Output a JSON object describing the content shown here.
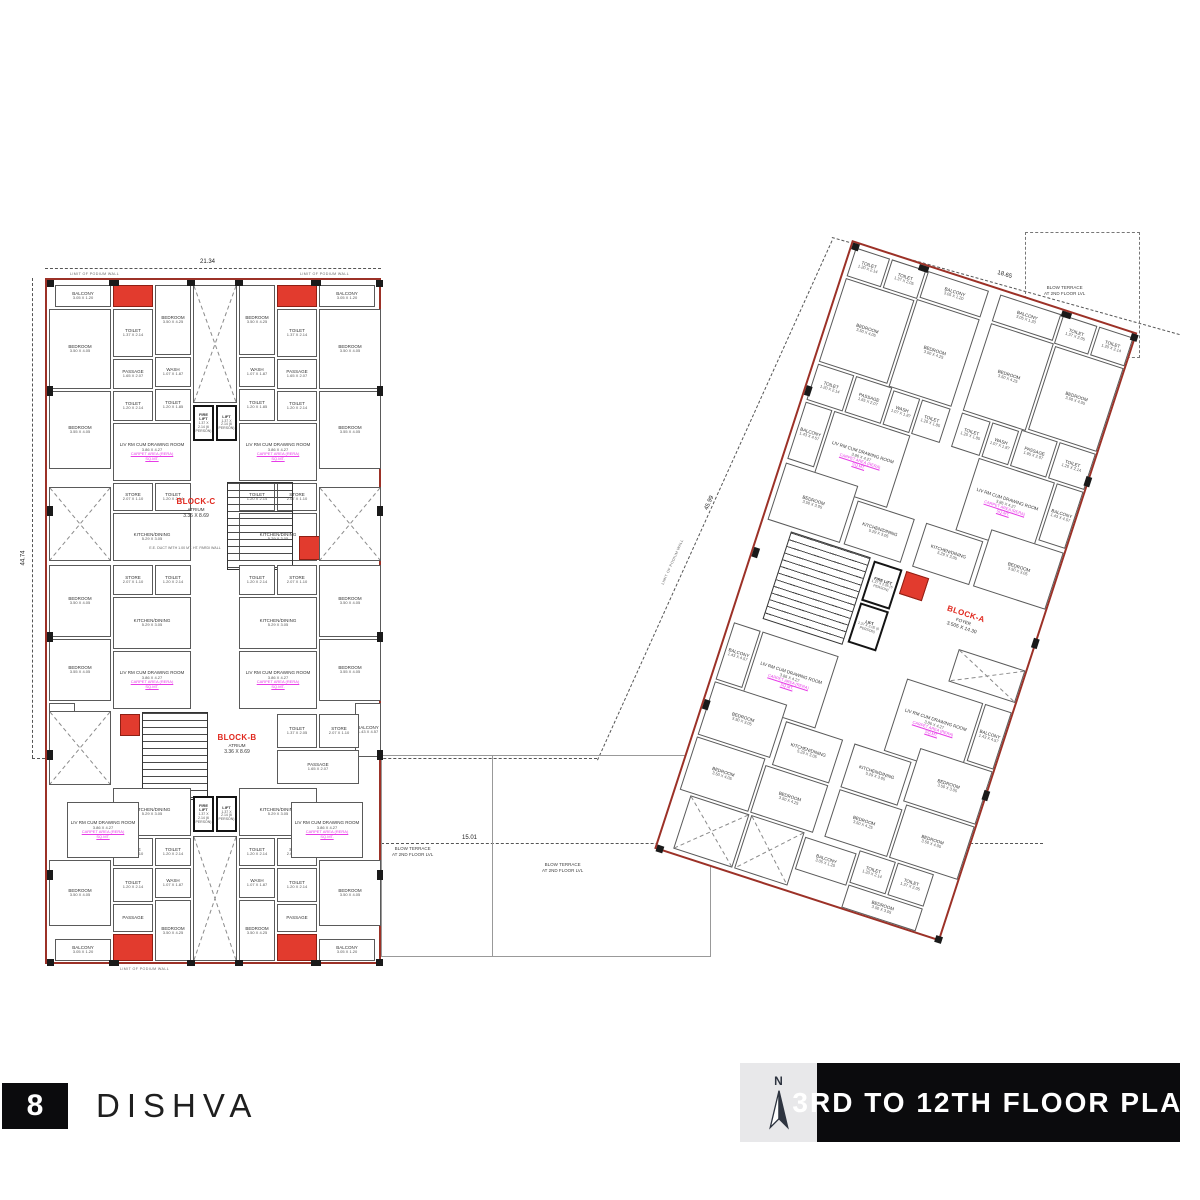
{
  "footer": {
    "page_number": "8",
    "project_name": "DISHVA",
    "plan_title": "3RD TO 12TH FLOOR PLAN",
    "north_label": "N"
  },
  "labels": {
    "carpet_line1": "CARPET AREA (RERA)",
    "carpet_line2": "SQ.MT.",
    "podium": "LIMIT OF PODIUM WALL",
    "terrace": "BLOW TERRACE",
    "terrace_sub": "AT 2ND FLOOR LVL",
    "duct_note": "E.E. DUCT WITH 1.00 MT. HT. PARDI WALL"
  },
  "dimensions": {
    "top": "21.34",
    "left": "44.74",
    "between": "15.01",
    "right_side": "45.99",
    "right_top": "18.65"
  },
  "colors": {
    "perimeter_red": "#9c3127",
    "duct_red": "#e23b2e",
    "block_label_red": "#e0281e",
    "carpet_magenta": "#e73ce7",
    "footer_black": "#0b0b0d",
    "north_box_gray": "#e8e8ea"
  },
  "left_building": {
    "x": 45,
    "y": 278,
    "w": 336,
    "h": 686,
    "rooms": [
      {
        "x": 8,
        "y": 5,
        "w": 56,
        "h": 22,
        "n": "BALCONY",
        "d": "3.05 X 1.20",
        "m": 1
      },
      {
        "x": 66,
        "y": 5,
        "w": 40,
        "h": 22,
        "c": "duct",
        "m": 1
      },
      {
        "x": 2,
        "y": 29,
        "w": 62,
        "h": 80,
        "n": "BEDROOM",
        "d": "3.50 X 4.05",
        "m": 1
      },
      {
        "x": 66,
        "y": 29,
        "w": 40,
        "h": 48,
        "n": "TOILET",
        "d": "1.37 X 2.14",
        "m": 1
      },
      {
        "x": 66,
        "y": 79,
        "w": 40,
        "h": 30,
        "n": "PASSAGE",
        "d": "1.65 X 2.07",
        "m": 1
      },
      {
        "x": 108,
        "y": 5,
        "w": 36,
        "h": 70,
        "n": "BEDROOM",
        "d": "3.50 X 4.25",
        "m": 1
      },
      {
        "x": 108,
        "y": 77,
        "w": 36,
        "h": 30,
        "n": "WASH",
        "d": "1.07 X 1.87",
        "m": 1
      },
      {
        "x": 108,
        "y": 109,
        "w": 36,
        "h": 32,
        "n": "TOILET",
        "d": "1.20 X 1.85",
        "m": 1
      },
      {
        "x": 2,
        "y": 111,
        "w": 62,
        "h": 78,
        "n": "BEDROOM",
        "d": "3.55 X 4.05",
        "m": 1
      },
      {
        "x": 66,
        "y": 111,
        "w": 40,
        "h": 30,
        "n": "TOILET",
        "d": "1.20 X 2.14",
        "m": 1
      },
      {
        "x": 66,
        "y": 143,
        "w": 78,
        "h": 58,
        "n": "LIV RM CUM DRAWING ROOM",
        "d": "3.86 X 4.27",
        "cp": 1,
        "m": 1
      },
      {
        "x": 66,
        "y": 203,
        "w": 40,
        "h": 28,
        "n": "STORE",
        "d": "2.07 X 1.10",
        "m": 1
      },
      {
        "x": 108,
        "y": 203,
        "w": 36,
        "h": 28,
        "n": "TOILET",
        "d": "1.20 X 2.14",
        "m": 1
      },
      {
        "x": 66,
        "y": 233,
        "w": 78,
        "h": 48,
        "n": "KITCHEN/DINING",
        "d": "5.29 X 3.05",
        "m": 1
      },
      {
        "x": 146,
        "y": 5,
        "w": 44,
        "h": 118,
        "c": "terr"
      },
      {
        "x": 146,
        "y": 125,
        "w": 21,
        "h": 36,
        "c": "lift",
        "n": "FIRE LIFT",
        "d": "1.37 X 2.14 (6 PERSON)"
      },
      {
        "x": 169,
        "y": 125,
        "w": 21,
        "h": 36,
        "c": "lift",
        "n": "LIFT",
        "d": "1.37 X 2.14 (6 PERSON)"
      },
      {
        "x": 180,
        "y": 202,
        "w": 66,
        "h": 88,
        "c": "stair"
      },
      {
        "x": 122,
        "y": 206,
        "w": 54,
        "h": 44,
        "c": "blk",
        "n": "BLOCK-C",
        "s": "ATRIUM",
        "d": "3.36 X 8.69"
      },
      {
        "x": 252,
        "y": 256,
        "w": 24,
        "h": 24,
        "c": "duct"
      },
      {
        "x": 100,
        "y": 255,
        "w": 76,
        "h": 26,
        "c": "note",
        "n": "E.E. DUCT WITH 1.00 MT. HT. PARDI WALL"
      },
      {
        "x": 2,
        "y": 207,
        "w": 62,
        "h": 74,
        "c": "terr",
        "m": 1
      },
      {
        "x": 66,
        "y": 285,
        "w": 40,
        "h": 30,
        "n": "STORE",
        "d": "2.07 X 1.10",
        "m": 1
      },
      {
        "x": 108,
        "y": 285,
        "w": 36,
        "h": 30,
        "n": "TOILET",
        "d": "1.20 X 2.14",
        "m": 1
      },
      {
        "x": 2,
        "y": 285,
        "w": 62,
        "h": 72,
        "n": "BEDROOM",
        "d": "3.50 X 4.05",
        "m": 1
      },
      {
        "x": 2,
        "y": 359,
        "w": 62,
        "h": 62,
        "n": "BEDROOM",
        "d": "3.55 X 4.05",
        "m": 1
      },
      {
        "x": 2,
        "y": 423,
        "w": 26,
        "h": 54,
        "n": "BALCONY",
        "d": "1.43 X 4.57",
        "m": 1
      },
      {
        "x": 66,
        "y": 317,
        "w": 78,
        "h": 52,
        "n": "KITCHEN/DINING",
        "d": "5.29 X 3.05",
        "m": 1
      },
      {
        "x": 66,
        "y": 371,
        "w": 78,
        "h": 58,
        "n": "LIV RM CUM DRAWING ROOM",
        "d": "3.86 X 4.27",
        "cp": 1,
        "m": 1
      },
      {
        "x": 95,
        "y": 432,
        "w": 66,
        "h": 88,
        "c": "stair"
      },
      {
        "x": 73,
        "y": 434,
        "w": 20,
        "h": 22,
        "c": "duct"
      },
      {
        "x": 163,
        "y": 442,
        "w": 54,
        "h": 44,
        "c": "blk",
        "n": "BLOCK-B",
        "s": "ATRIUM",
        "d": "3.36 X 8.69"
      },
      {
        "x": 2,
        "y": 431,
        "w": 62,
        "h": 74,
        "c": "terr"
      },
      {
        "x": 230,
        "y": 434,
        "w": 40,
        "h": 34,
        "n": "TOILET",
        "d": "1.37 X 2.05"
      },
      {
        "x": 272,
        "y": 434,
        "w": 40,
        "h": 34,
        "n": "STORE",
        "d": "2.07 X 1.10"
      },
      {
        "x": 230,
        "y": 470,
        "w": 82,
        "h": 34,
        "n": "PASSAGE",
        "d": "1.65 X 2.07"
      },
      {
        "x": 66,
        "y": 508,
        "w": 78,
        "h": 48,
        "n": "KITCHEN/DINING",
        "d": "5.29 X 3.05",
        "m": 1
      },
      {
        "x": 66,
        "y": 558,
        "w": 40,
        "h": 28,
        "n": "STORE",
        "d": "2.07 X 1.10",
        "m": 1
      },
      {
        "x": 108,
        "y": 558,
        "w": 36,
        "h": 28,
        "n": "TOILET",
        "d": "1.20 X 2.14",
        "m": 1
      },
      {
        "x": 20,
        "y": 522,
        "w": 72,
        "h": 56,
        "n": "LIV RM CUM DRAWING ROOM",
        "d": "3.86 X 4.27",
        "cp": 1,
        "m": 1
      },
      {
        "x": 2,
        "y": 580,
        "w": 62,
        "h": 66,
        "n": "BEDROOM",
        "d": "3.50 X 4.05",
        "m": 1
      },
      {
        "x": 8,
        "y": 659,
        "w": 56,
        "h": 22,
        "n": "BALCONY",
        "d": "3.05 X 1.20",
        "m": 1
      },
      {
        "x": 66,
        "y": 588,
        "w": 40,
        "h": 34,
        "n": "TOILET",
        "d": "1.20 X 2.14",
        "m": 1
      },
      {
        "x": 66,
        "y": 624,
        "w": 40,
        "h": 28,
        "n": "PASSAGE",
        "m": 1
      },
      {
        "x": 66,
        "y": 654,
        "w": 40,
        "h": 27,
        "c": "duct",
        "m": 1
      },
      {
        "x": 108,
        "y": 588,
        "w": 36,
        "h": 30,
        "n": "WASH",
        "d": "1.07 X 1.87",
        "m": 1
      },
      {
        "x": 108,
        "y": 620,
        "w": 36,
        "h": 61,
        "n": "BEDROOM",
        "d": "3.50 X 4.25",
        "m": 1
      },
      {
        "x": 146,
        "y": 516,
        "w": 21,
        "h": 36,
        "c": "lift",
        "n": "FIRE LIFT",
        "d": "1.37 X 2.14 (6 PERSON)"
      },
      {
        "x": 169,
        "y": 516,
        "w": 21,
        "h": 36,
        "c": "lift",
        "n": "LIFT",
        "d": "1.37 X 2.14 (6 PERSON)"
      },
      {
        "x": 146,
        "y": 556,
        "w": 44,
        "h": 125,
        "c": "terr"
      },
      {
        "x": 0,
        "y": 0,
        "w": 7,
        "h": 7,
        "c": "col",
        "m": 1
      },
      {
        "x": 0,
        "y": 679,
        "w": 7,
        "h": 7,
        "c": "col",
        "m": 1
      },
      {
        "x": 0,
        "y": 106,
        "w": 6,
        "h": 10,
        "c": "col",
        "m": 1
      },
      {
        "x": 0,
        "y": 226,
        "w": 6,
        "h": 10,
        "c": "col",
        "m": 1
      },
      {
        "x": 0,
        "y": 352,
        "w": 6,
        "h": 10,
        "c": "col",
        "m": 1
      },
      {
        "x": 0,
        "y": 470,
        "w": 6,
        "h": 10,
        "c": "col",
        "m": 1
      },
      {
        "x": 0,
        "y": 590,
        "w": 6,
        "h": 10,
        "c": "col",
        "m": 1
      },
      {
        "x": 62,
        "y": 0,
        "w": 10,
        "h": 6,
        "c": "col",
        "m": 1
      },
      {
        "x": 140,
        "y": 0,
        "w": 8,
        "h": 6,
        "c": "col",
        "m": 1
      },
      {
        "x": 62,
        "y": 680,
        "w": 10,
        "h": 6,
        "c": "col",
        "m": 1
      },
      {
        "x": 140,
        "y": 680,
        "w": 8,
        "h": 6,
        "c": "col",
        "m": 1
      }
    ]
  },
  "right_building": {
    "x": 852,
    "y": 240,
    "w": 300,
    "h": 640,
    "angle": 18,
    "rooms": [
      {
        "x": 4,
        "y": 4,
        "w": 36,
        "h": 30,
        "n": "TOILET",
        "d": "1.20 X 2.14",
        "m": 1
      },
      {
        "x": 42,
        "y": 4,
        "w": 36,
        "h": 30,
        "n": "TOILET",
        "d": "1.37 X 2.05",
        "m": 1
      },
      {
        "x": 80,
        "y": 4,
        "w": 64,
        "h": 28,
        "n": "BALCONY",
        "d": "3.05 X 1.20",
        "m": 1
      },
      {
        "x": 4,
        "y": 36,
        "w": 72,
        "h": 88,
        "n": "BEDROOM",
        "d": "3.50 X 4.05",
        "m": 1
      },
      {
        "x": 78,
        "y": 34,
        "w": 66,
        "h": 92,
        "n": "BEDROOM",
        "d": "3.50 X 4.25",
        "m": 1
      },
      {
        "x": 4,
        "y": 126,
        "w": 38,
        "h": 38,
        "n": "TOILET",
        "d": "1.20 X 2.14",
        "m": 1
      },
      {
        "x": 44,
        "y": 126,
        "w": 38,
        "h": 38,
        "n": "PASSAGE",
        "d": "1.65 X 2.07",
        "m": 1
      },
      {
        "x": 84,
        "y": 128,
        "w": 28,
        "h": 36,
        "n": "WASH",
        "d": "1.07 X 1.87",
        "m": 1
      },
      {
        "x": 114,
        "y": 128,
        "w": 30,
        "h": 36,
        "n": "TOILET",
        "d": "1.20 X 1.85",
        "m": 1
      },
      {
        "x": 34,
        "y": 166,
        "w": 80,
        "h": 76,
        "n": "LIV RM CUM DRAWING ROOM",
        "d": "3.86 X 4.27",
        "cp": 1,
        "m": 1
      },
      {
        "x": 4,
        "y": 166,
        "w": 28,
        "h": 60,
        "n": "BALCONY",
        "d": "1.43 X 4.57",
        "m": 1
      },
      {
        "x": 84,
        "y": 244,
        "w": 60,
        "h": 46,
        "n": "KITCHEN/DINING",
        "d": "5.29 X 3.05",
        "m": 1
      },
      {
        "x": 4,
        "y": 230,
        "w": 76,
        "h": 60,
        "n": "BEDROOM",
        "d": "3.50 X 3.05",
        "m": 1
      },
      {
        "x": 30,
        "y": 294,
        "w": 84,
        "h": 92,
        "c": "stair"
      },
      {
        "x": 118,
        "y": 296,
        "w": 30,
        "h": 42,
        "c": "lift",
        "n": "FIRE LIFT",
        "d": "1.37 X 2.05 (6 PERSON)"
      },
      {
        "x": 118,
        "y": 340,
        "w": 30,
        "h": 42,
        "c": "lift",
        "n": "LIFT",
        "d": "1.37 X 2.05 (6 PERSON)"
      },
      {
        "x": 152,
        "y": 296,
        "w": 24,
        "h": 24,
        "c": "duct"
      },
      {
        "x": 184,
        "y": 300,
        "w": 76,
        "h": 50,
        "c": "blk",
        "n": "BLOCK-A",
        "s": "FOYER",
        "d": "3.505 X 14.30"
      },
      {
        "x": 226,
        "y": 354,
        "w": 70,
        "h": 34,
        "c": "terr"
      },
      {
        "x": 34,
        "y": 398,
        "w": 80,
        "h": 76,
        "n": "LIV RM CUM DRAWING ROOM",
        "d": "3.86 X 4.27",
        "cp": 1,
        "m": 1
      },
      {
        "x": 4,
        "y": 398,
        "w": 28,
        "h": 60,
        "n": "BALCONY",
        "d": "1.43 X 4.57",
        "m": 1
      },
      {
        "x": 84,
        "y": 476,
        "w": 60,
        "h": 46,
        "n": "KITCHEN/DINING",
        "d": "5.29 X 3.05",
        "m": 1
      },
      {
        "x": 4,
        "y": 460,
        "w": 76,
        "h": 56,
        "n": "BEDROOM",
        "d": "3.50 X 3.05",
        "m": 1
      },
      {
        "x": 4,
        "y": 518,
        "w": 72,
        "h": 56,
        "n": "BEDROOM",
        "d": "3.50 X 4.05",
        "m": 1
      },
      {
        "x": 78,
        "y": 524,
        "w": 66,
        "h": 50,
        "n": "BEDROOM",
        "d": "3.50 X 4.25",
        "m": 1
      },
      {
        "x": 16,
        "y": 576,
        "w": 62,
        "h": 56,
        "c": "terr"
      },
      {
        "x": 80,
        "y": 576,
        "w": 56,
        "h": 56,
        "c": "terr"
      },
      {
        "x": 138,
        "y": 580,
        "w": 54,
        "h": 34,
        "n": "BALCONY",
        "d": "3.05 X 1.20"
      },
      {
        "x": 194,
        "y": 576,
        "w": 38,
        "h": 34,
        "n": "TOILET",
        "d": "1.20 X 2.14"
      },
      {
        "x": 234,
        "y": 576,
        "w": 38,
        "h": 34,
        "n": "TOILET",
        "d": "1.37 X 2.05"
      },
      {
        "x": 194,
        "y": 612,
        "w": 78,
        "h": 24,
        "n": "BEDROOM",
        "d": "3.50 X 3.05"
      },
      {
        "x": 0,
        "y": 0,
        "w": 7,
        "h": 7,
        "c": "col",
        "m": 1
      },
      {
        "x": 0,
        "y": 633,
        "w": 7,
        "h": 7,
        "c": "col",
        "m": 1
      },
      {
        "x": 70,
        "y": 0,
        "w": 10,
        "h": 6,
        "c": "col",
        "m": 1
      },
      {
        "x": 0,
        "y": 150,
        "w": 6,
        "h": 10,
        "c": "col",
        "m": 1
      },
      {
        "x": 0,
        "y": 320,
        "w": 6,
        "h": 10,
        "c": "col",
        "m": 1
      },
      {
        "x": 0,
        "y": 480,
        "w": 6,
        "h": 10,
        "c": "col",
        "m": 1
      }
    ]
  }
}
